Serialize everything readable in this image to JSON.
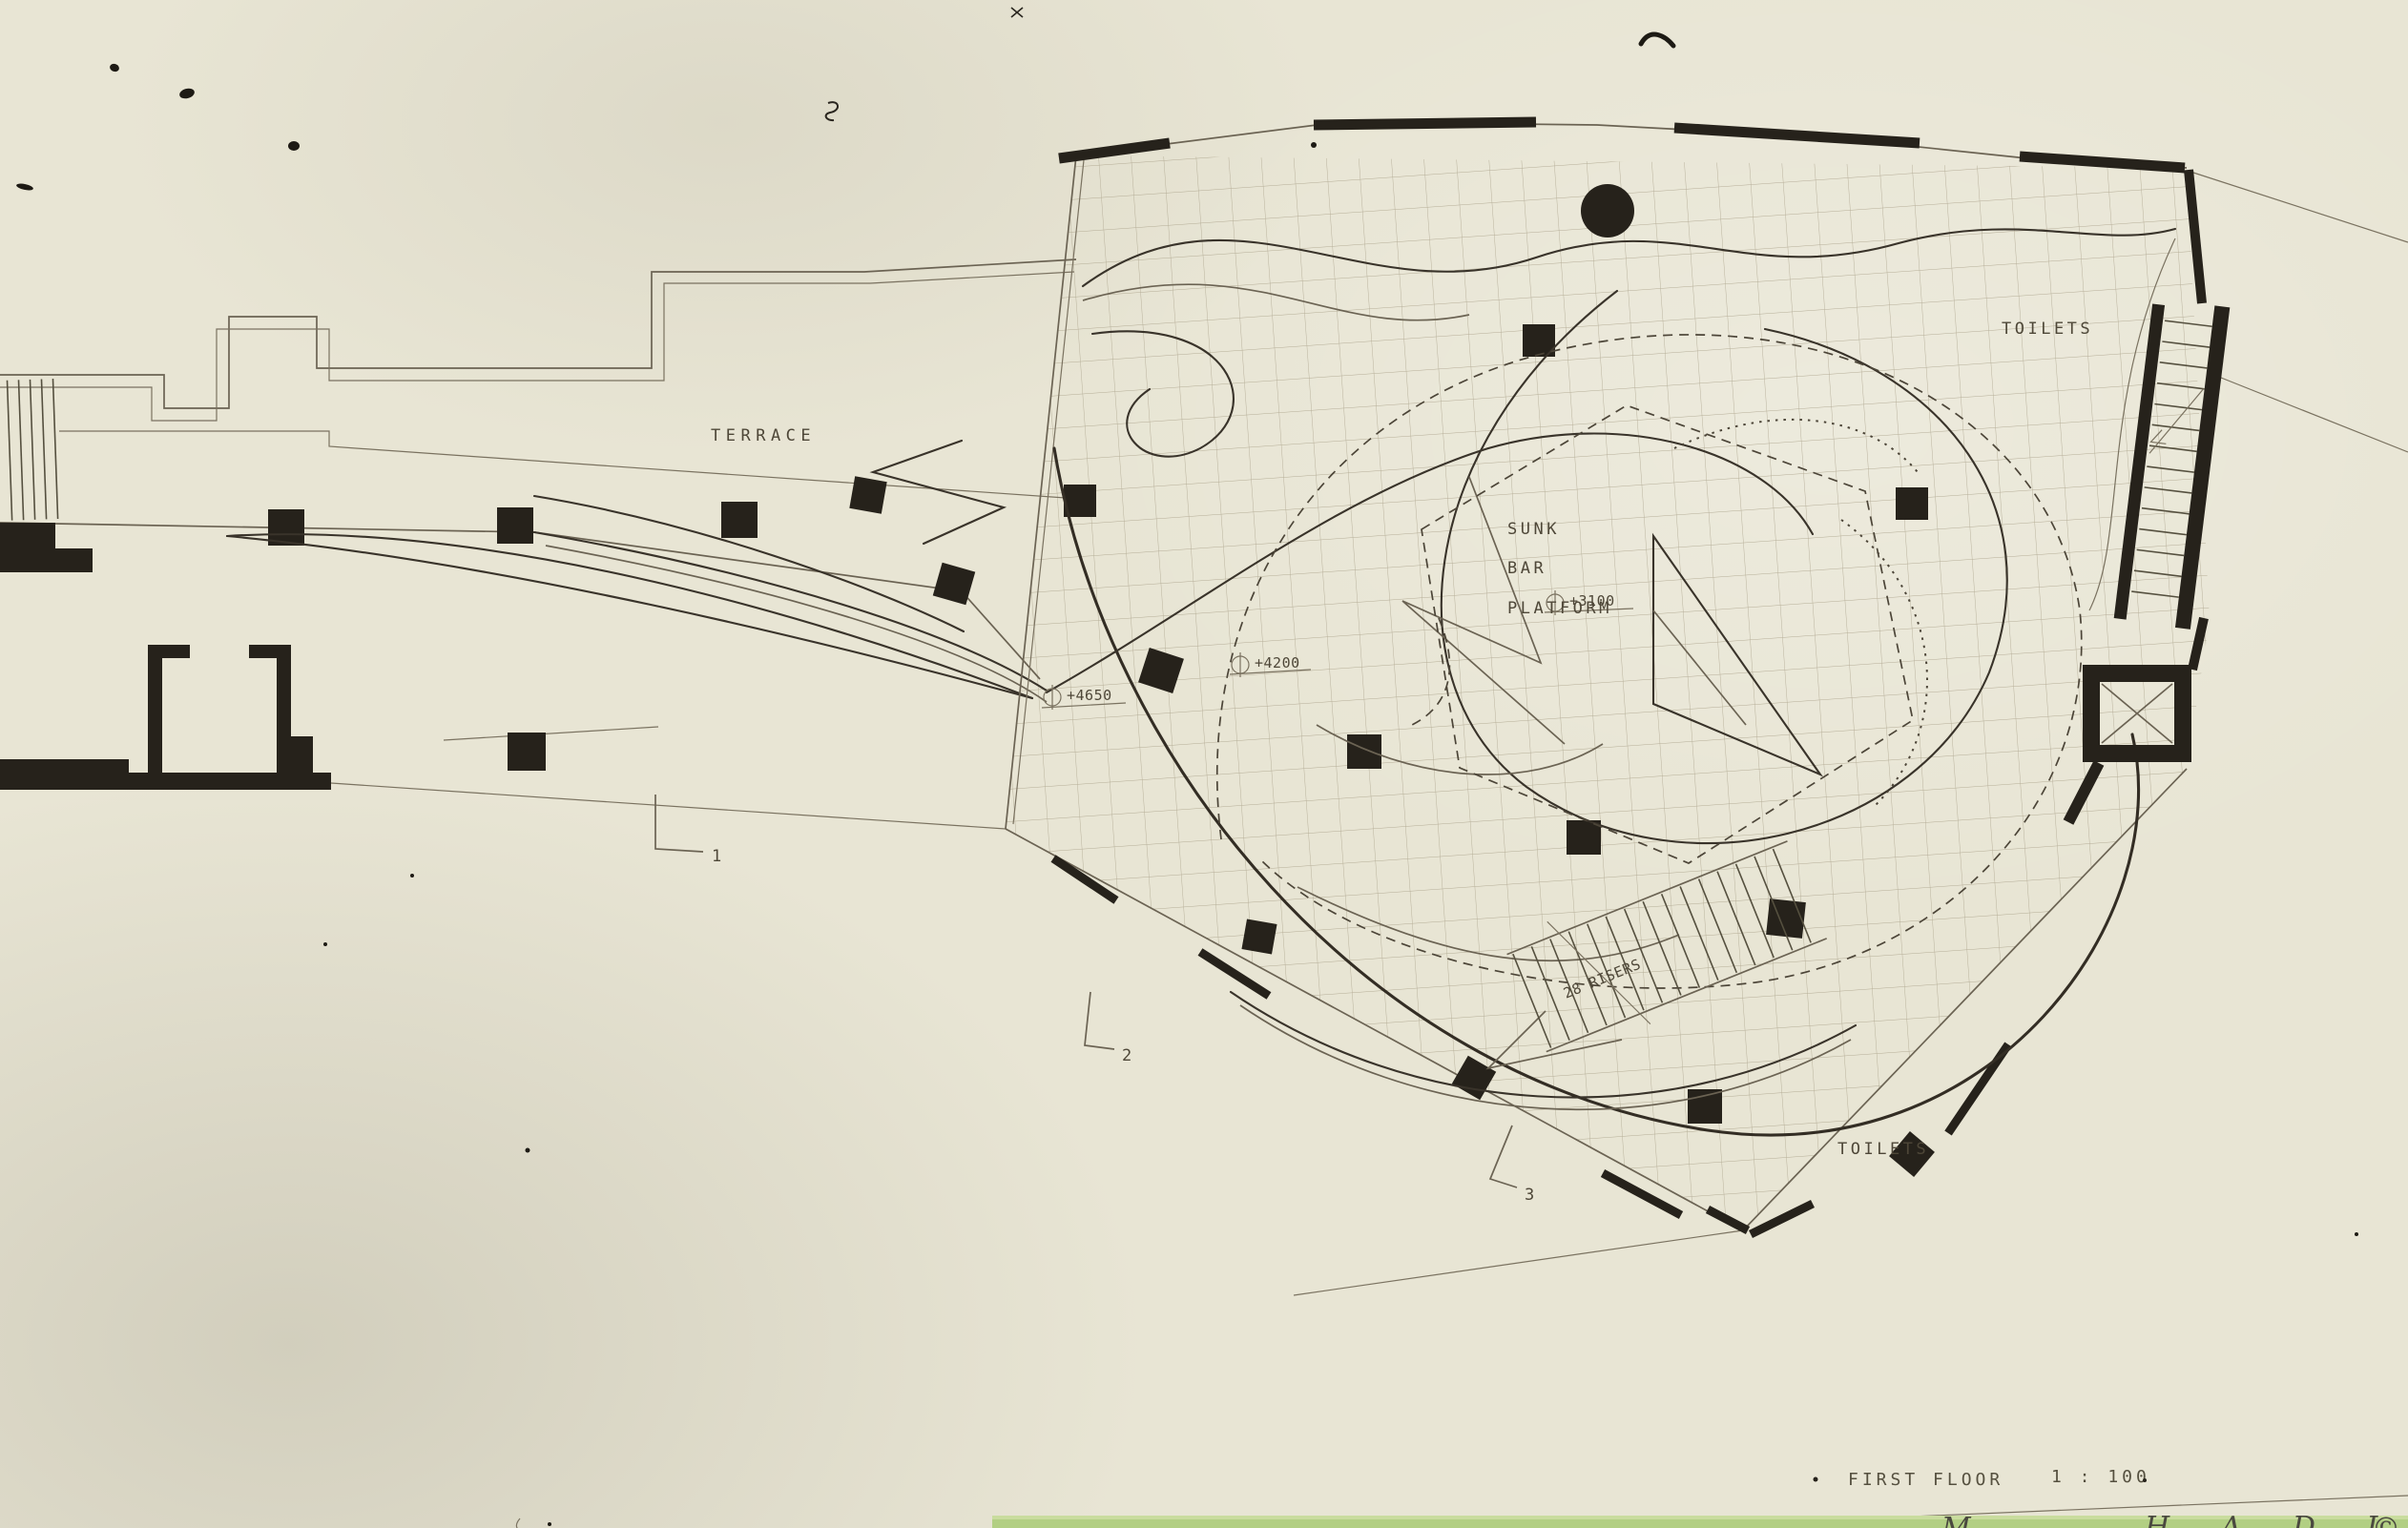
{
  "document": {
    "kind": "architectural first floor plan, scanned hand drawing",
    "floor_title": "FIRST FLOOR",
    "scale": "1 : 100"
  },
  "labels": {
    "terrace": "TERRACE",
    "toilets_top": "TOILETS",
    "toilets_bottom": "TOILETS",
    "sunk": "SUNK",
    "bar": "BAR",
    "platform": "PLATFORM",
    "risers": "28 RISERS"
  },
  "levels": {
    "terrace_level": "+4650",
    "hall_level": "+4200",
    "platform_level": "+3100"
  },
  "section_markers": {
    "m1": "1",
    "m2": "2",
    "m3": "3"
  },
  "title_block": {
    "title": "FIRST FLOOR",
    "scale": "1 : 100"
  },
  "signature": {
    "prefix": "M",
    "name_letters": "H A D I D",
    "mark": "©"
  },
  "stairs": {
    "main_visible_treads": 15,
    "right_visible_treads": 14,
    "entry_visible_treads": 5
  },
  "colors": {
    "paper": "#e8e5d4",
    "ink_dark": "#26221b",
    "ink_line": "#4c4538",
    "grid": "#a89f87",
    "signature_strip_green": "#b2cf83"
  }
}
